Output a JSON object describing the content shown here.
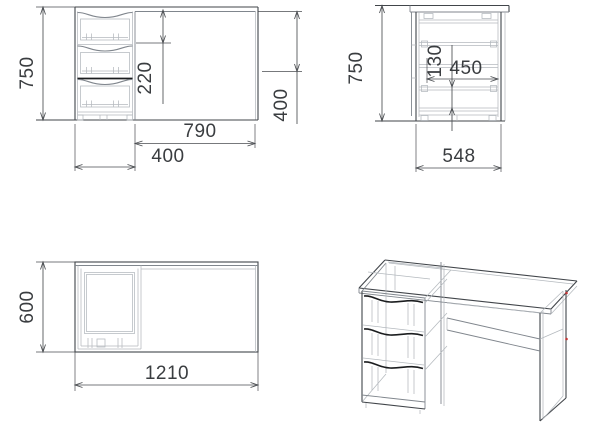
{
  "dims": {
    "front_height": "750",
    "front_top_to_drawer": "220",
    "front_knee_width": "790",
    "front_pedestal_width": "400",
    "front_panel_height": "400",
    "side_height": "750",
    "side_drawer_height": "130",
    "side_drawer_depth": "450",
    "side_depth": "548",
    "top_depth": "600",
    "top_width": "1210"
  },
  "colors": {
    "background": "#ffffff",
    "line_dark": "#41454a",
    "line_medium": "#80868d",
    "line_light": "#b4b9be",
    "line_heavy": "#1b1d1f",
    "dim_line": "#4a4d51",
    "text": "#3a3d40",
    "accent_red": "#c23535"
  }
}
